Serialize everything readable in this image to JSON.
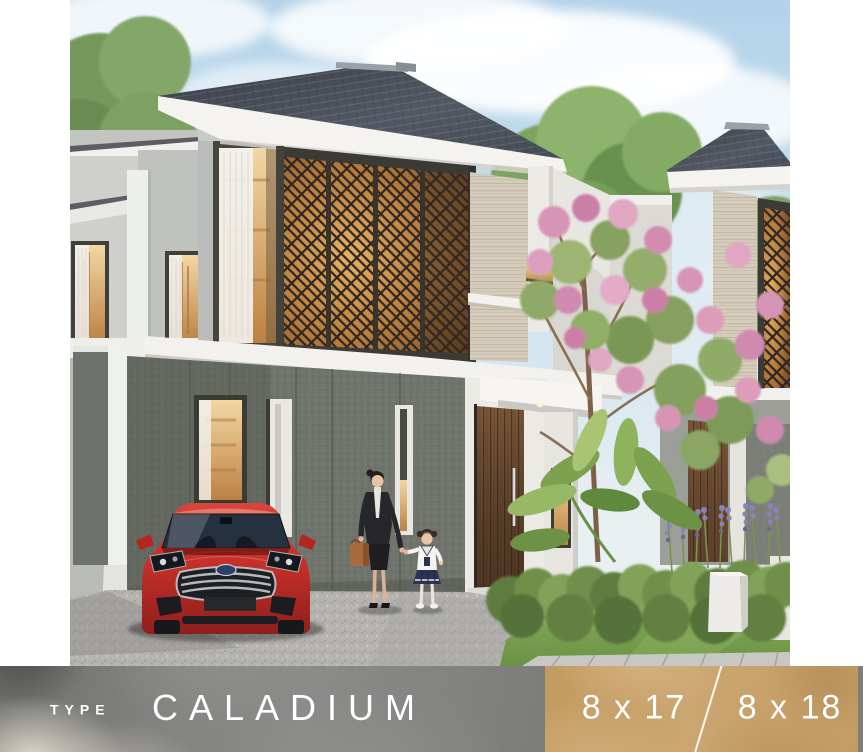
{
  "banner": {
    "type_label": "TYPE",
    "house_name": "CALADIUM",
    "size_left": "8 x 17",
    "size_right": "8 x 18",
    "sizes": [
      "8 x 17",
      "8 x 18"
    ],
    "colors": {
      "left_bg": "#828280",
      "right_bg": "#c9a26c",
      "text": "#ffffff",
      "divider": "#ffffff"
    }
  },
  "scene": {
    "description": "Architectural rendering of a modern two-storey tropical house (type Caladium): dark hip roof with white fascia, bronze geometric lattice screens with warm backlit glow, travertine stone accents, dark speckled ground-floor wall, timber entry door, red sedan parked on a gravel driveway, a woman with a handbag walking hand-in-hand with a little girl, pink flowering tree, green hedge, lavender and white planters beside a lawn.",
    "elements": {
      "sky": "light blue sky with soft clouds",
      "main_house": "two-storey house with lattice screen facade",
      "red_car": "red sedan parked in carport",
      "people": "woman and child walking",
      "garden": "hedge, tropical plant, lavender, pink flowering tree"
    },
    "palette": {
      "sky": "#bcd7ea",
      "roof": "#474c55",
      "fascia": "#f4f3ef",
      "lattice_glow": "#d89a4e",
      "lattice_frame": "#3c3a34",
      "travertine": "#d5cbba",
      "ground_wall": "#6f746c",
      "door_wood": "#7a573a",
      "car_red": "#c62f2c",
      "lawn": "#7aa351",
      "gravel": "#b4b3af",
      "blossom_pink": "#d795b5"
    }
  }
}
